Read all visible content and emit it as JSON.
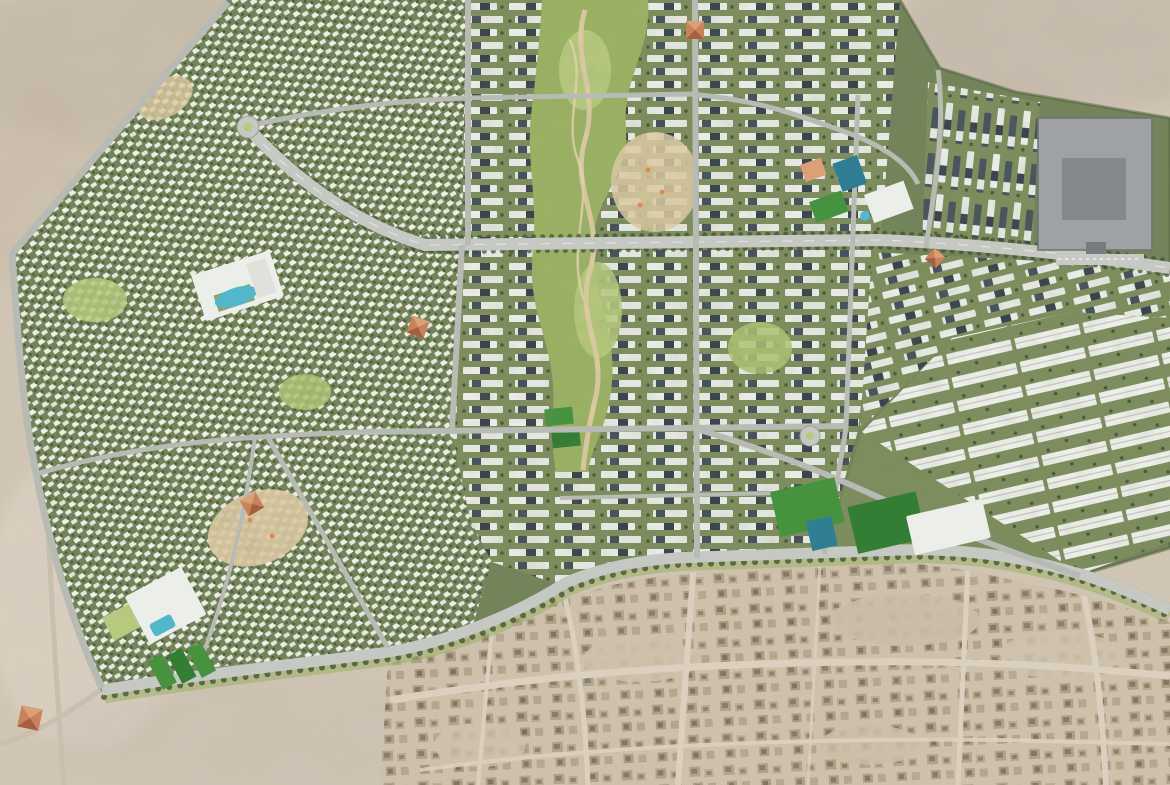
{
  "meta": {
    "title": "Aerial master-plan rendering of a desert community development",
    "view": "top-down aerial render, no visible text or UI elements",
    "canvas": {
      "width": 1170,
      "height": 785
    }
  },
  "palette": {
    "sand": "#d0c4b3",
    "sand_gray": "#c7bcb0",
    "sand_dark": "#b2a492",
    "sand_light": "#e4dbcd",
    "dev_green": "#74845a",
    "dev_green_dark": "#4c5c3a",
    "villa_white": "#eef0e9",
    "apt_base": "#7d8d5e",
    "apt_white": "#e9ebe6",
    "apt_dark": "#3b444e",
    "park_green": "#9ab164",
    "park_light": "#b6c97e",
    "path_tan": "#dcc9a3",
    "road_gray": "#b7bbb4",
    "avenue_gray": "#c6c9c3",
    "tree_green": "#3c4f2d",
    "field_green": "#46923f",
    "field_green_dark": "#347d35",
    "court_teal": "#2f7e94",
    "pool_blue": "#52b7ca",
    "building_white": "#eceee9",
    "big_building_gray": "#9fa2a4",
    "big_building_dark": "#85898c",
    "terracotta": "#c9825c",
    "terracotta_light": "#dba077",
    "terracotta_dark": "#a5603f",
    "playground_orange": "#e08a4c",
    "old_town_sand": "#cec1ab",
    "old_town_block": "#ae9f87",
    "old_town_block_dark": "#857660",
    "old_town_road": "#dcd1c0",
    "desert_road": "#c9bfae"
  },
  "features": {
    "desert": {
      "label": "Surrounding desert terrain"
    },
    "development": {
      "label": "Landscaped master-planned community"
    },
    "villa_district_west": {
      "label": "Villa district (west and southwest)"
    },
    "apartment_district_center": {
      "label": "Apartment district (center)"
    },
    "apartment_district_northeast": {
      "label": "Apartment block cluster (northeast)"
    },
    "apartment_district_east": {
      "label": "Apartment band (east)"
    },
    "row_district_southeast": {
      "label": "Long residential rows (southeast)"
    },
    "central_park": {
      "label": "Central linear park with winding paths"
    },
    "main_avenue": {
      "label": "Tree-lined main avenue"
    },
    "south_boulevard": {
      "label": "Curved southern boulevard"
    },
    "roundabout_northwest": {
      "label": "Ornamental roundabout"
    },
    "roundabout_east": {
      "label": "Roundabout"
    },
    "clubhouse_pool": {
      "label": "Clubhouse with lagoon pool"
    },
    "school_southwest": {
      "label": "School campus with pool and sports strips"
    },
    "school_northeast": {
      "label": "School campus with courts and pool"
    },
    "sports_fields_south": {
      "label": "Sports fields and courts"
    },
    "community_mall": {
      "label": "Large gray community building"
    },
    "white_building_south": {
      "label": "White institutional building"
    },
    "mosque": {
      "label": "Pyramid-roofed community building"
    },
    "old_town": {
      "label": "Existing low-rise desert neighborhood"
    }
  }
}
